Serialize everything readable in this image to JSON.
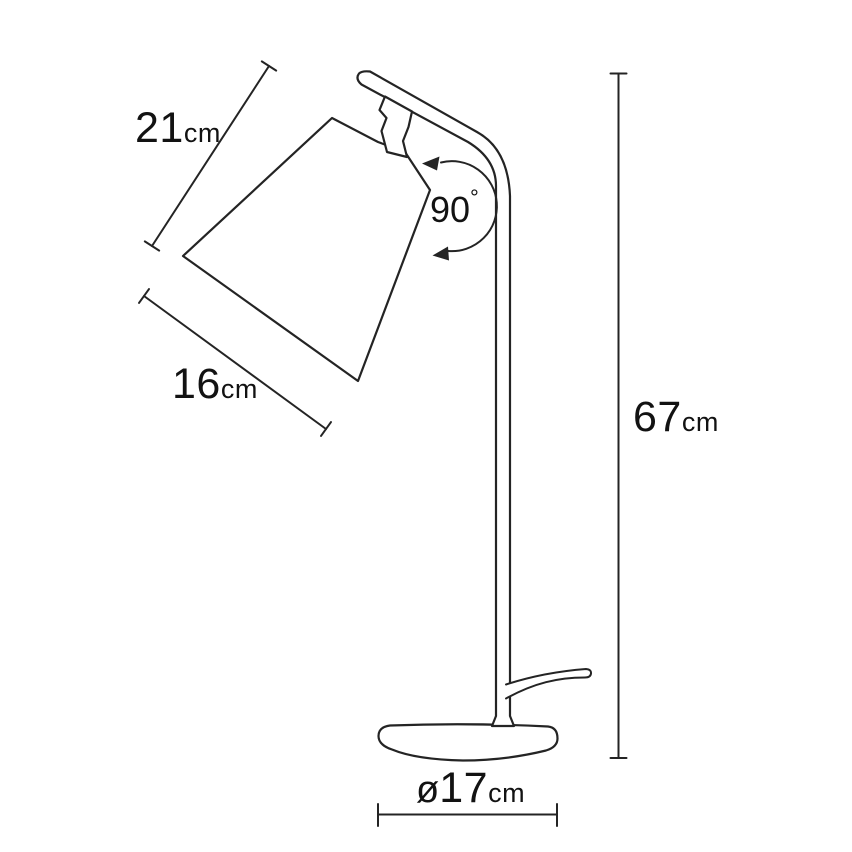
{
  "figure": {
    "subject": "table-lamp-outline-drawing",
    "background": "#ffffff",
    "line_color": "#242424",
    "text_color": "#121212"
  },
  "dimensions": {
    "shade_slant": {
      "value": "21",
      "unit": "cm"
    },
    "shade_width": {
      "value": "16",
      "unit": "cm"
    },
    "lamp_height": {
      "value": "67",
      "unit": "cm"
    },
    "base_diameter": {
      "symbol": "ø",
      "value": "17",
      "unit": "cm"
    },
    "head_rotation": {
      "value": "90",
      "unit": "°"
    }
  }
}
